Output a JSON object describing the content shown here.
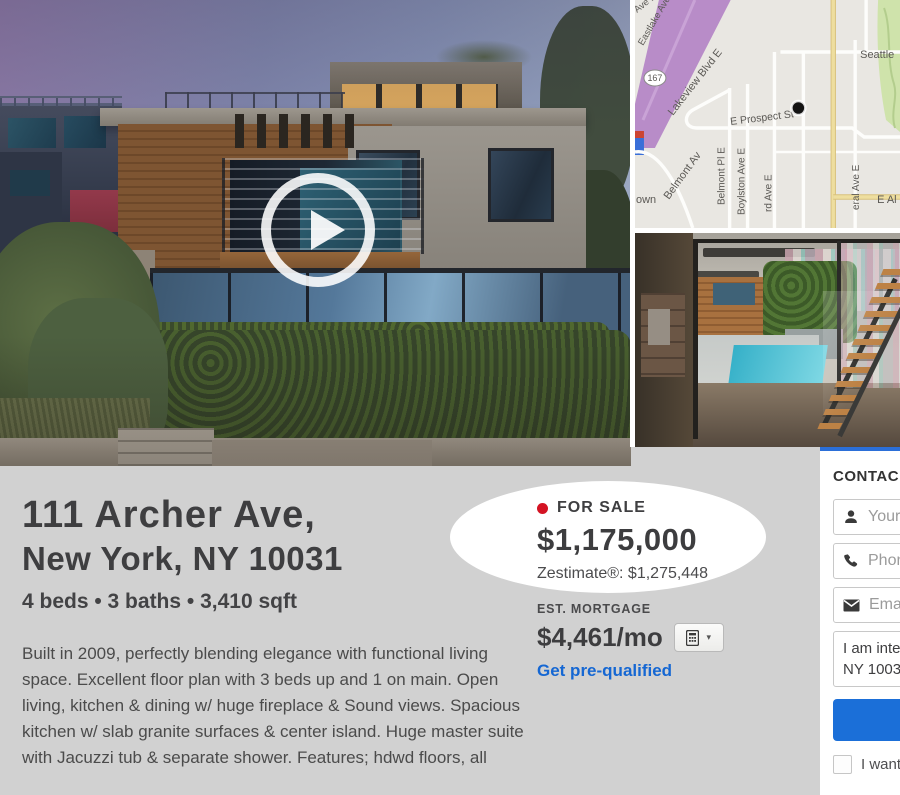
{
  "listing": {
    "status_label": "FOR SALE",
    "price": "$1,175,000",
    "zestimate": "Zestimate®: $1,275,448",
    "address_line1": "111 Archer Ave,",
    "address_line2": "New York, NY 10031",
    "facts": "4 beds • 3 baths • 3,410 sqft",
    "description": "Built in 2009, perfectly blending elegance with functional living space. Excellent floor plan with 3 beds up and 1 on main. Open living, kitchen & dining w/ huge fireplace & Sound views. Spacious kitchen w/ slab granite surfaces & center island. Huge master suite with Jacuzzi tub & separate shower. Features; hdwd floors, all",
    "mortgage": {
      "label": "EST. MORTGAGE",
      "amount": "$4,461/mo",
      "prequalify_link": "Get pre-qualified"
    }
  },
  "contact_panel": {
    "header": "CONTAC",
    "name_field": "Your n",
    "phone_field": "Phone",
    "email_field": "Email",
    "message_line1": "I am intere",
    "message_line2": "NY 10031.",
    "financing_checkbox": "I want f"
  },
  "map": {
    "labels": {
      "ave_e": "Ave E",
      "eastlake_ave": "Eastlake Ave",
      "route_shield": "167",
      "lakeview_blvd": "Lakeview Blvd E",
      "prospect_st": "E Prospect St",
      "belmont_pl": "Belmont Pl E",
      "boylston_ave": "Boylston Ave E",
      "harvard_ave": "rd Ave E",
      "federal_ave": "eral Ave E",
      "belmont_av": "Belmont Av",
      "town_partial": "own",
      "seattle": "Seattle",
      "aloha_st": "E Al"
    }
  },
  "icons": {
    "play": "right-pointing-triangle",
    "map_marker": "filled-dot",
    "person": "user-silhouette",
    "phone": "handset",
    "email": "envelope",
    "calculator": "calculator-grid",
    "caret_down": "▾"
  },
  "colors": {
    "page_bg": "#d1d1d1",
    "status_dot_red": "#d41323",
    "link_blue": "#1567d3",
    "button_blue": "#1b6fd8",
    "panel_top_border_blue": "#2b6fd8"
  }
}
